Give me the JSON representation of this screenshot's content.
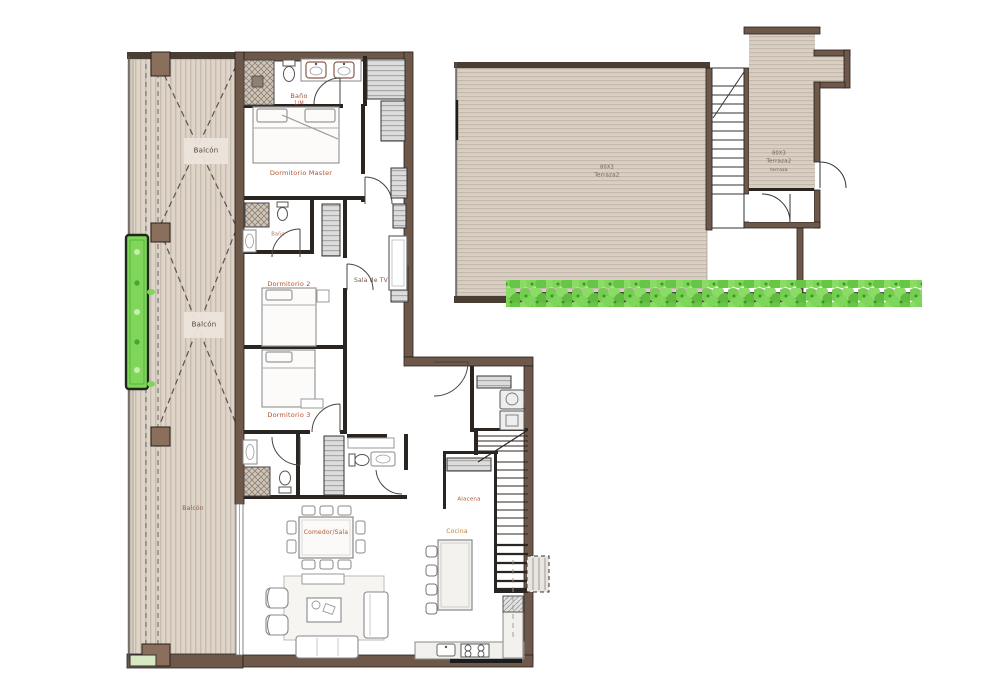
{
  "colors": {
    "exterior_wall": "#6e5849",
    "interior_wall": "#2b2521",
    "balcony_floor": "#ded4c8",
    "terrace_floor": "#d9cfc4",
    "closet_gray": "#dcdcdc",
    "hedge_green": "#6fcb4b",
    "planter_green": "#7fd65b",
    "room_label": "#b0502c"
  },
  "labels": {
    "balcony_top": "Balcón",
    "balcony_mid": "Balcón",
    "balcony_bottom": "Balcón",
    "master_bath": "Baño",
    "master_bath_sub": "1/M",
    "master_bedroom": "Dormitorio Master",
    "bath2": "Baño",
    "bedroom2": "Dormitorio 2",
    "tv_room": "Sala de TV",
    "bedroom3": "Dormitorio 3",
    "pantry": "Alacena",
    "dining_living": "Comedor/Sala",
    "kitchen": "Cocina",
    "terrace_left_code": "80X3",
    "terrace_left_name": "Terraza2",
    "terrace_right_code": "80X3",
    "terrace_right_name": "Terraza2",
    "terrace_right_sub": "terraza"
  }
}
